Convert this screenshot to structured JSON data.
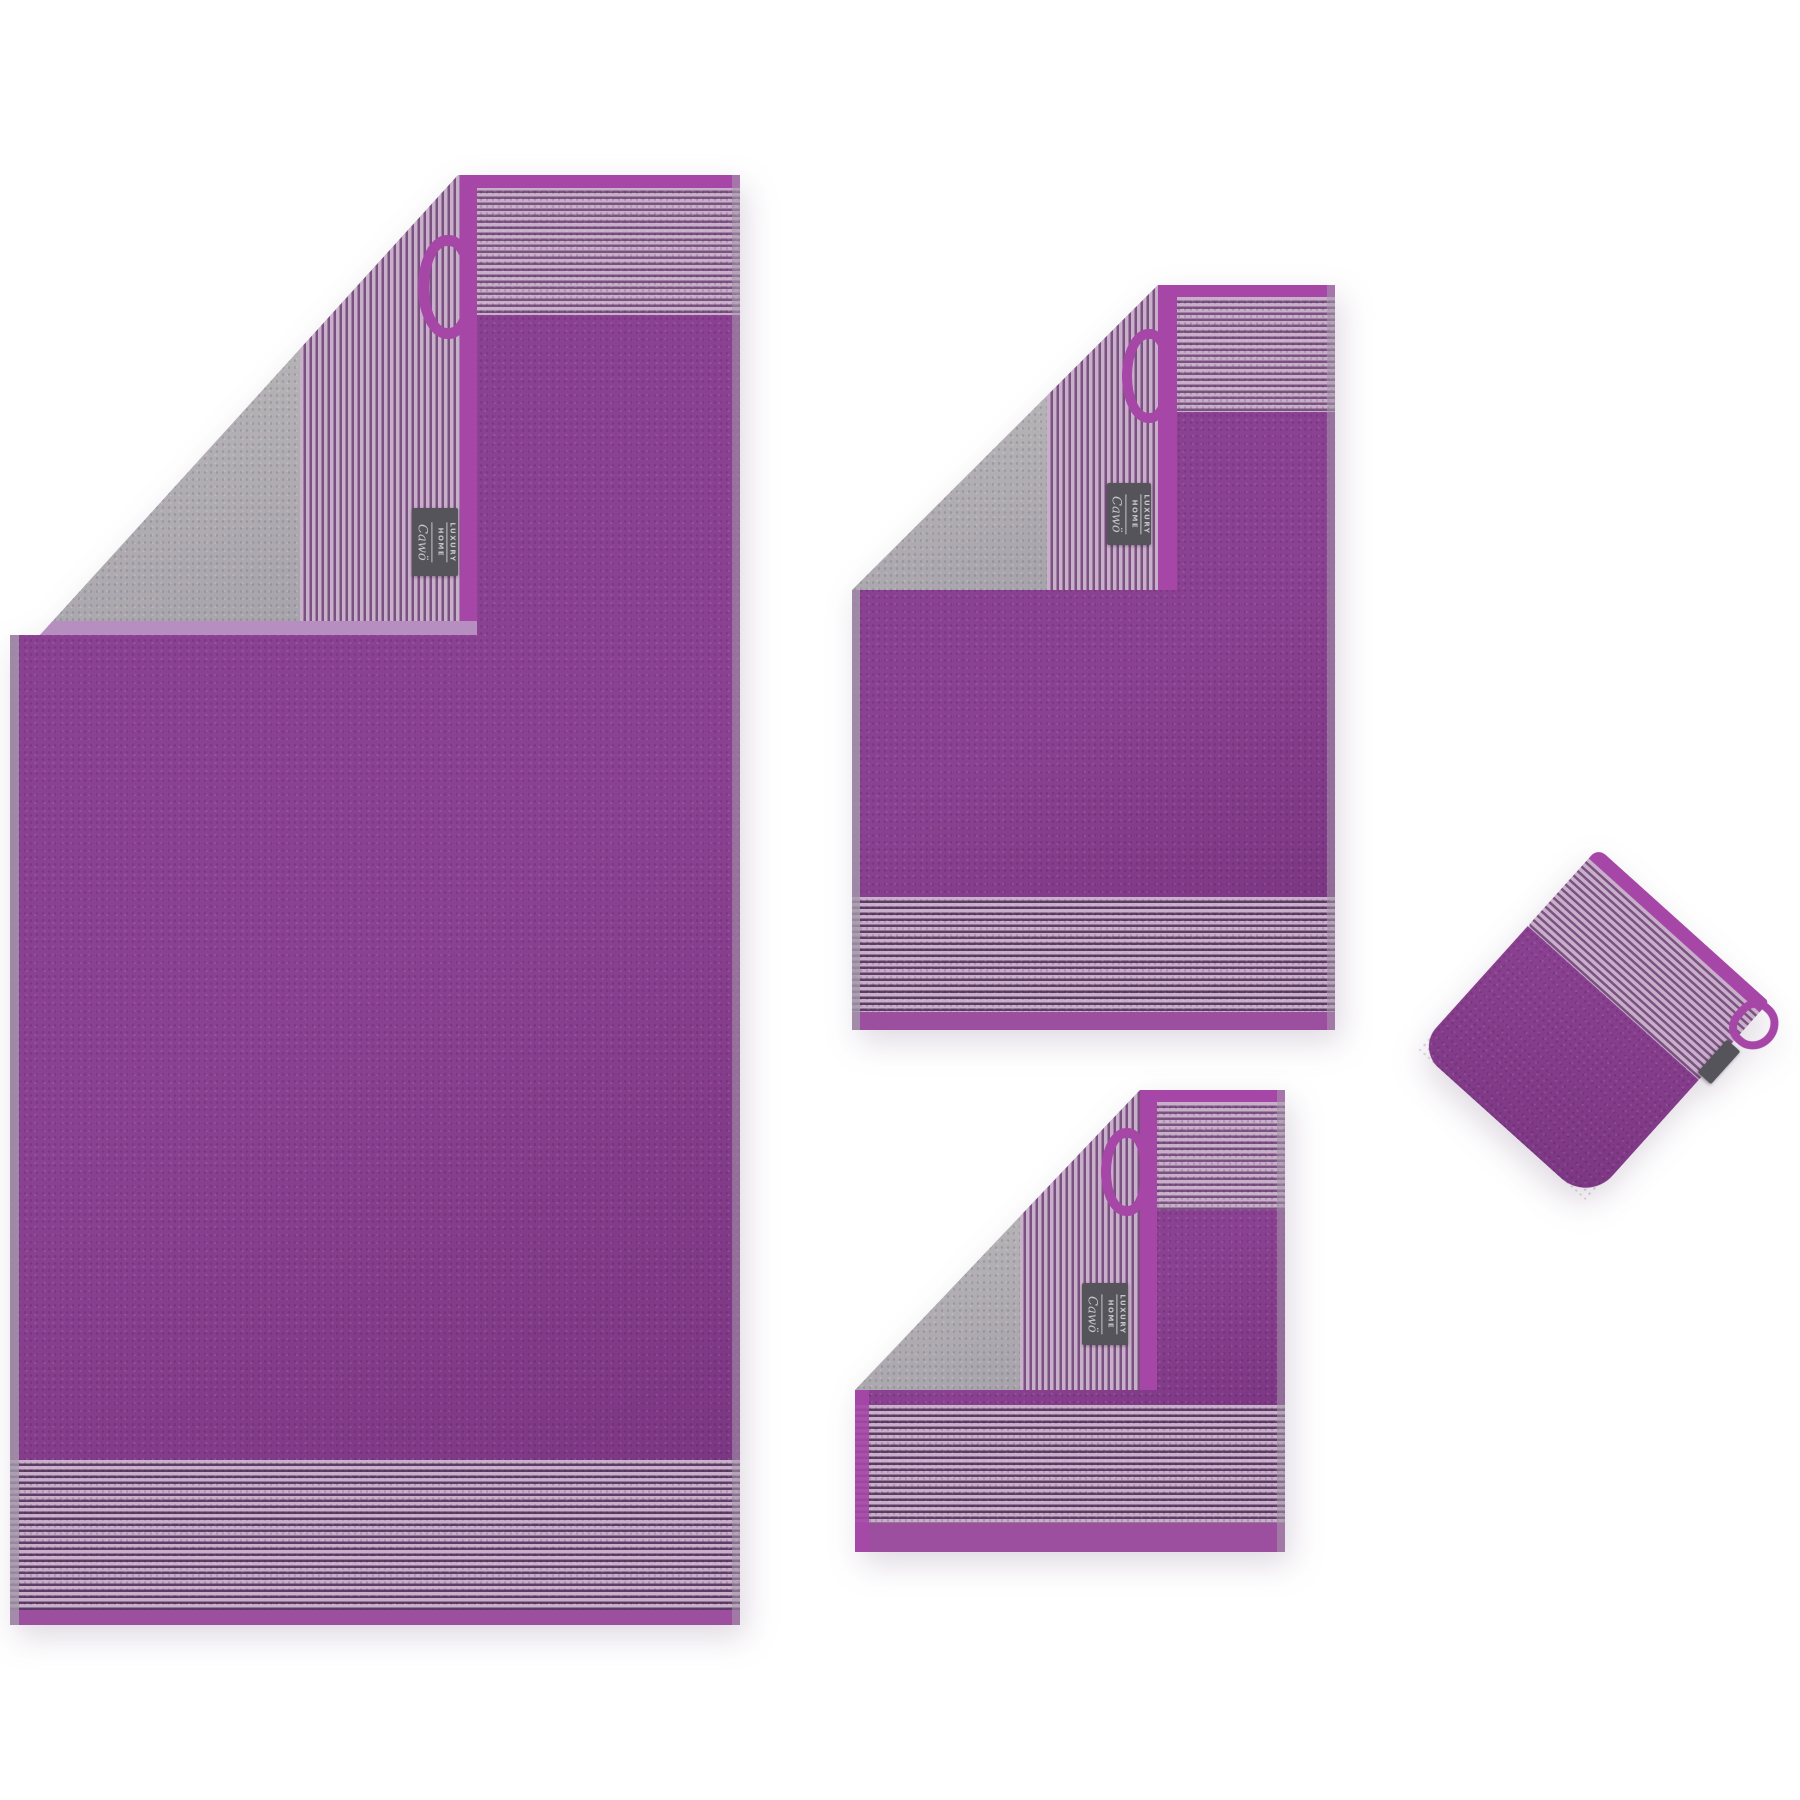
{
  "scene": {
    "type": "product-photo",
    "description": "Purple two-tone terry towel set with grey reverse side and pinstripe borders, shown as four items: bath towel, hand towel, guest towel and wash mitt, each with corner folded back, hanging loop and woven brand tag",
    "background": "#ffffff"
  },
  "tag": {
    "line1": "LUXURY",
    "line2": "HOME",
    "brand": "Cawö"
  },
  "items": [
    {
      "id": "bath-towel",
      "name": "Bath towel with folded corner"
    },
    {
      "id": "hand-towel",
      "name": "Hand towel with folded corner"
    },
    {
      "id": "guest-towel",
      "name": "Guest towel with folded corner"
    },
    {
      "id": "wash-mitt",
      "name": "Wash mitt"
    }
  ],
  "colors": {
    "body_purple": "#8b4191",
    "body_purple_dark": "#7c3783",
    "trim_purple": "#a647a7",
    "hem_purple": "#9c4f9f",
    "hem_lavender": "#b78ec0",
    "stripe_light": "#c8b0ca",
    "stripe_dark": "#7b5181",
    "stripe_dark_deep": "#5f3c66",
    "reverse_gray": "#b5b2b6",
    "reverse_gray_dark": "#a49fa8",
    "edge_gray": "#a59bab",
    "tag_bg": "#55545a",
    "tag_text": "#c6c5c9"
  }
}
